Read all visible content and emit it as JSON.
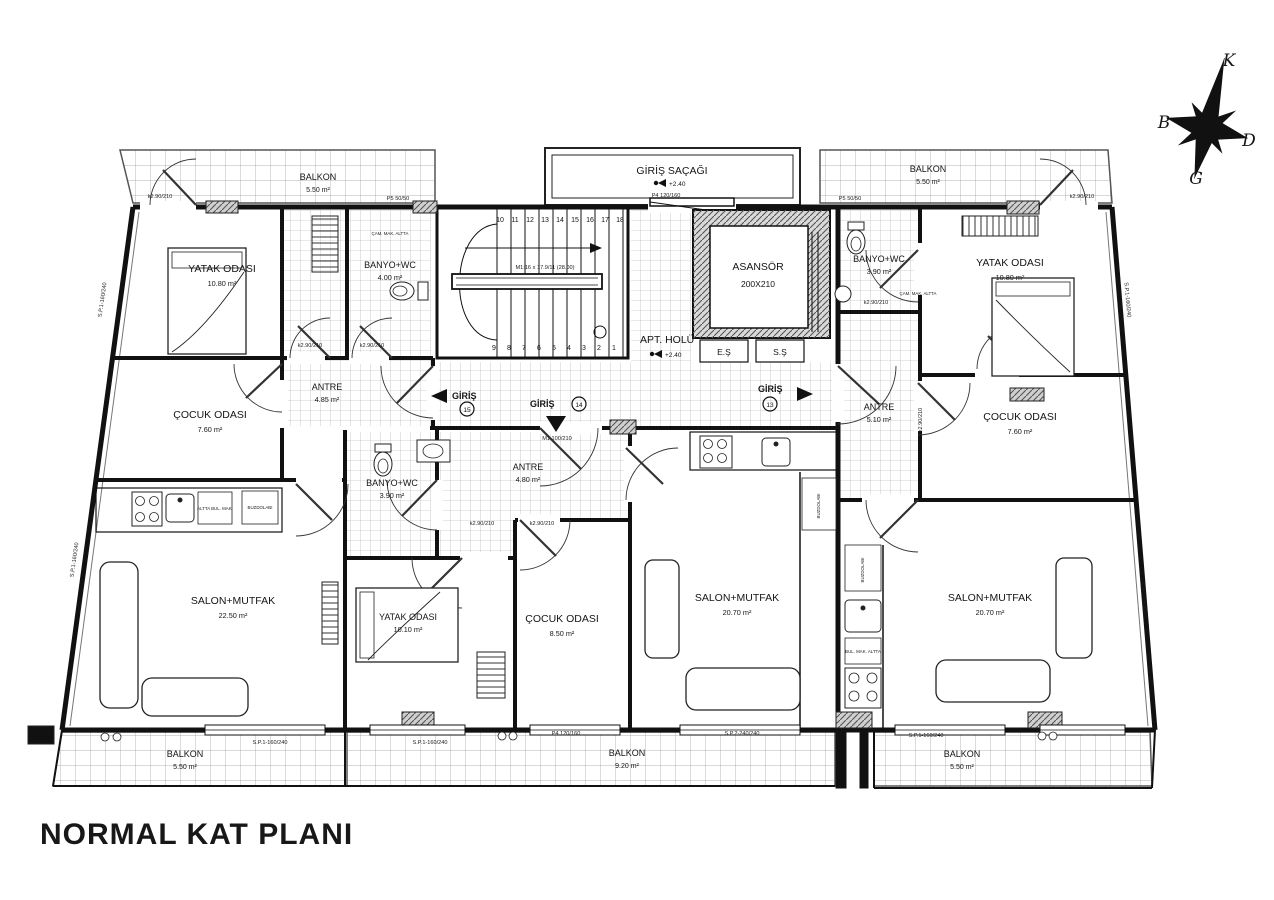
{
  "title": "NORMAL KAT PLANI",
  "compass": {
    "n": "K",
    "w": "B",
    "e": "D",
    "s": "G"
  },
  "canopy": {
    "name": "GİRİŞ SAÇAĞI",
    "elev": "+2.40"
  },
  "hall": {
    "name": "APT. HOLÜ",
    "elev": "+2.40"
  },
  "elevator": {
    "name": "ASANSÖR",
    "size": "200X210"
  },
  "shafts": {
    "es": "E.Ş",
    "ss": "S.Ş"
  },
  "stairs": {
    "spec": "M1:16 x 17.9/11 (28.00)",
    "top": [
      "10",
      "11",
      "12",
      "13",
      "14",
      "15",
      "16",
      "17",
      "18"
    ],
    "bottom": [
      "9",
      "8",
      "7",
      "6",
      "5",
      "4",
      "3",
      "2",
      "1"
    ]
  },
  "entrances": [
    {
      "label": "GİRİŞ",
      "no": "15"
    },
    {
      "label": "GİRİŞ",
      "no": "14"
    },
    {
      "label": "GİRİŞ",
      "no": "13"
    }
  ],
  "rooms": [
    {
      "name": "YATAK ODASI",
      "area": "10.80 m²"
    },
    {
      "name": "BANYO+WC",
      "area": "4.00 m²"
    },
    {
      "name": "ANTRE",
      "area": "4.85 m²"
    },
    {
      "name": "ÇOCUK ODASI",
      "area": "7.60 m²"
    },
    {
      "name": "SALON+MUTFAK",
      "area": "22.50 m²"
    },
    {
      "name": "BANYO+WC",
      "area": "3.90 m²"
    },
    {
      "name": "YATAK ODASI",
      "area": "10.80 m²"
    },
    {
      "name": "ANTRE",
      "area": "5.10 m²"
    },
    {
      "name": "ÇOCUK ODASI",
      "area": "7.60 m²"
    },
    {
      "name": "SALON+MUTFAK",
      "area": "20.70 m²"
    },
    {
      "name": "ANTRE",
      "area": "4.80 m²"
    },
    {
      "name": "BANYO+WC",
      "area": "3.90 m²"
    },
    {
      "name": "YATAK ODASI",
      "area": "10.10 m²"
    },
    {
      "name": "ÇOCUK ODASI",
      "area": "8.50 m²"
    },
    {
      "name": "SALON+MUTFAK",
      "area": "20.70 m²"
    }
  ],
  "balconies": [
    {
      "name": "BALKON",
      "area": "5.50 m²"
    },
    {
      "name": "BALKON",
      "area": "5.50 m²"
    },
    {
      "name": "BALKON",
      "area": "5.50 m²"
    },
    {
      "name": "BALKON",
      "area": "9.20 m²"
    },
    {
      "name": "BALKON",
      "area": "5.50 m²"
    }
  ],
  "labels": {
    "p4": "P4 120/160",
    "p5": "P5 50/50",
    "k290": "k2.90/210",
    "m1door": "M1 100/210",
    "sp1": "S.P.1-160/240",
    "sp2": "S.P.2-240/240",
    "cam": "ÇAM. MAK. ALTTA",
    "buz": "BUZDOLABI",
    "bulmak": "ALTTA BUL. MAK.",
    "bulmak2": "BUL. MAK. ALTTA"
  }
}
